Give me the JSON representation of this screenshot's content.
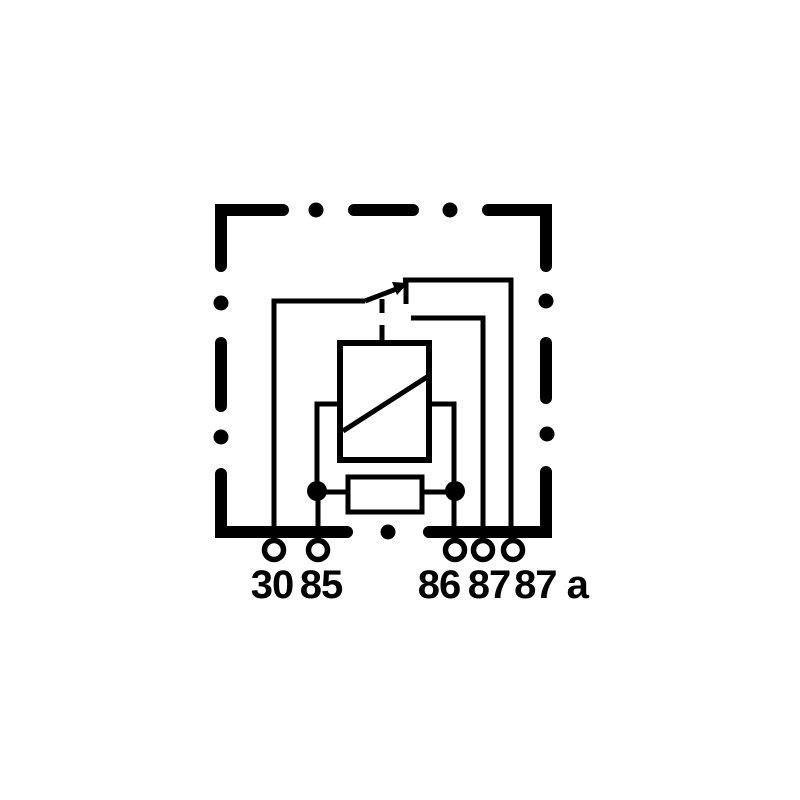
{
  "diagram": {
    "background_color": "#ffffff",
    "line_color": "#000000"
  },
  "terminals": [
    {
      "id": "30",
      "label": "30"
    },
    {
      "id": "85",
      "label": "85"
    },
    {
      "id": "86",
      "label": "86"
    },
    {
      "id": "87",
      "label": "87"
    },
    {
      "id": "87a",
      "label": "87 a"
    }
  ]
}
